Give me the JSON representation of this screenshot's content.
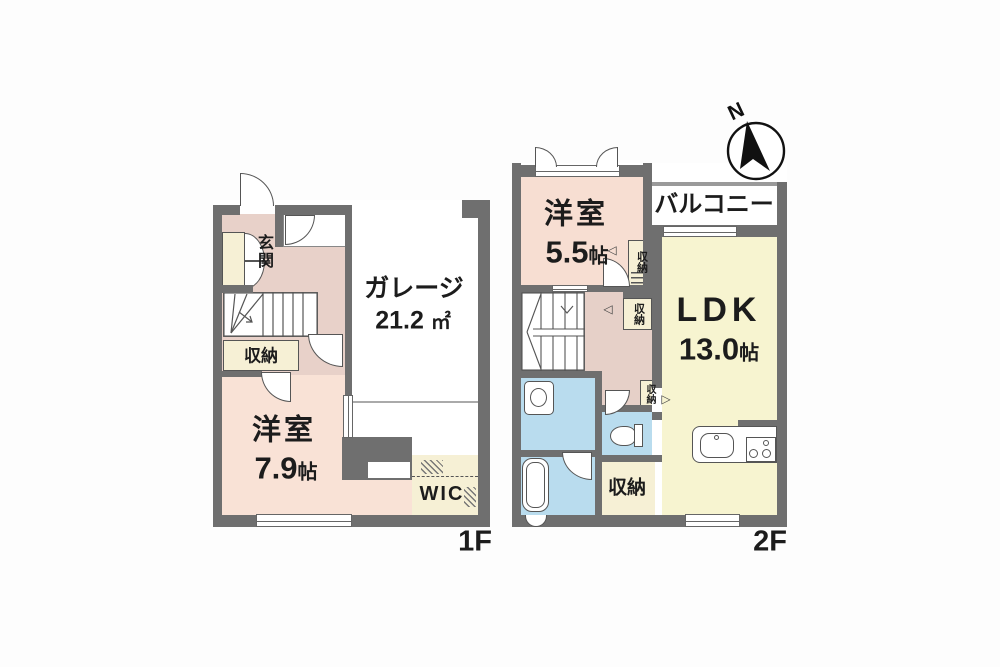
{
  "compass": {
    "label": "N"
  },
  "colors": {
    "wall": "#6f6f6f",
    "bedroom_pink": "#f9e2d6",
    "hall_pink": "#e8d1c9",
    "closet_cream": "#f6f0d5",
    "ldk_yellow": "#f7f4d0",
    "sanitary_blue": "#b9dcee"
  },
  "floor1": {
    "floor_label": "1F",
    "entrance": {
      "label": "玄関"
    },
    "storage": {
      "label": "収納"
    },
    "bedroom": {
      "name": "洋室",
      "size_num": "7.9",
      "size_unit": "帖"
    },
    "garage": {
      "name": "ガレージ",
      "size_num": "21.2",
      "size_unit": "㎡"
    },
    "wic": {
      "label": "WIC"
    }
  },
  "floor2": {
    "floor_label": "2F",
    "bedroom": {
      "name": "洋室",
      "size_num": "5.5",
      "size_unit": "帖"
    },
    "balcony": {
      "label": "バルコニー"
    },
    "ldk": {
      "name": "LDK",
      "size_num": "13.0",
      "size_unit": "帖"
    },
    "closet_top": {
      "label": "収納"
    },
    "closet_mid": {
      "label": "収納"
    },
    "closet_small": {
      "label": "収納"
    },
    "storage": {
      "label": "収納"
    }
  },
  "markers": {
    "open_left": "◁",
    "open_right": "▷"
  }
}
